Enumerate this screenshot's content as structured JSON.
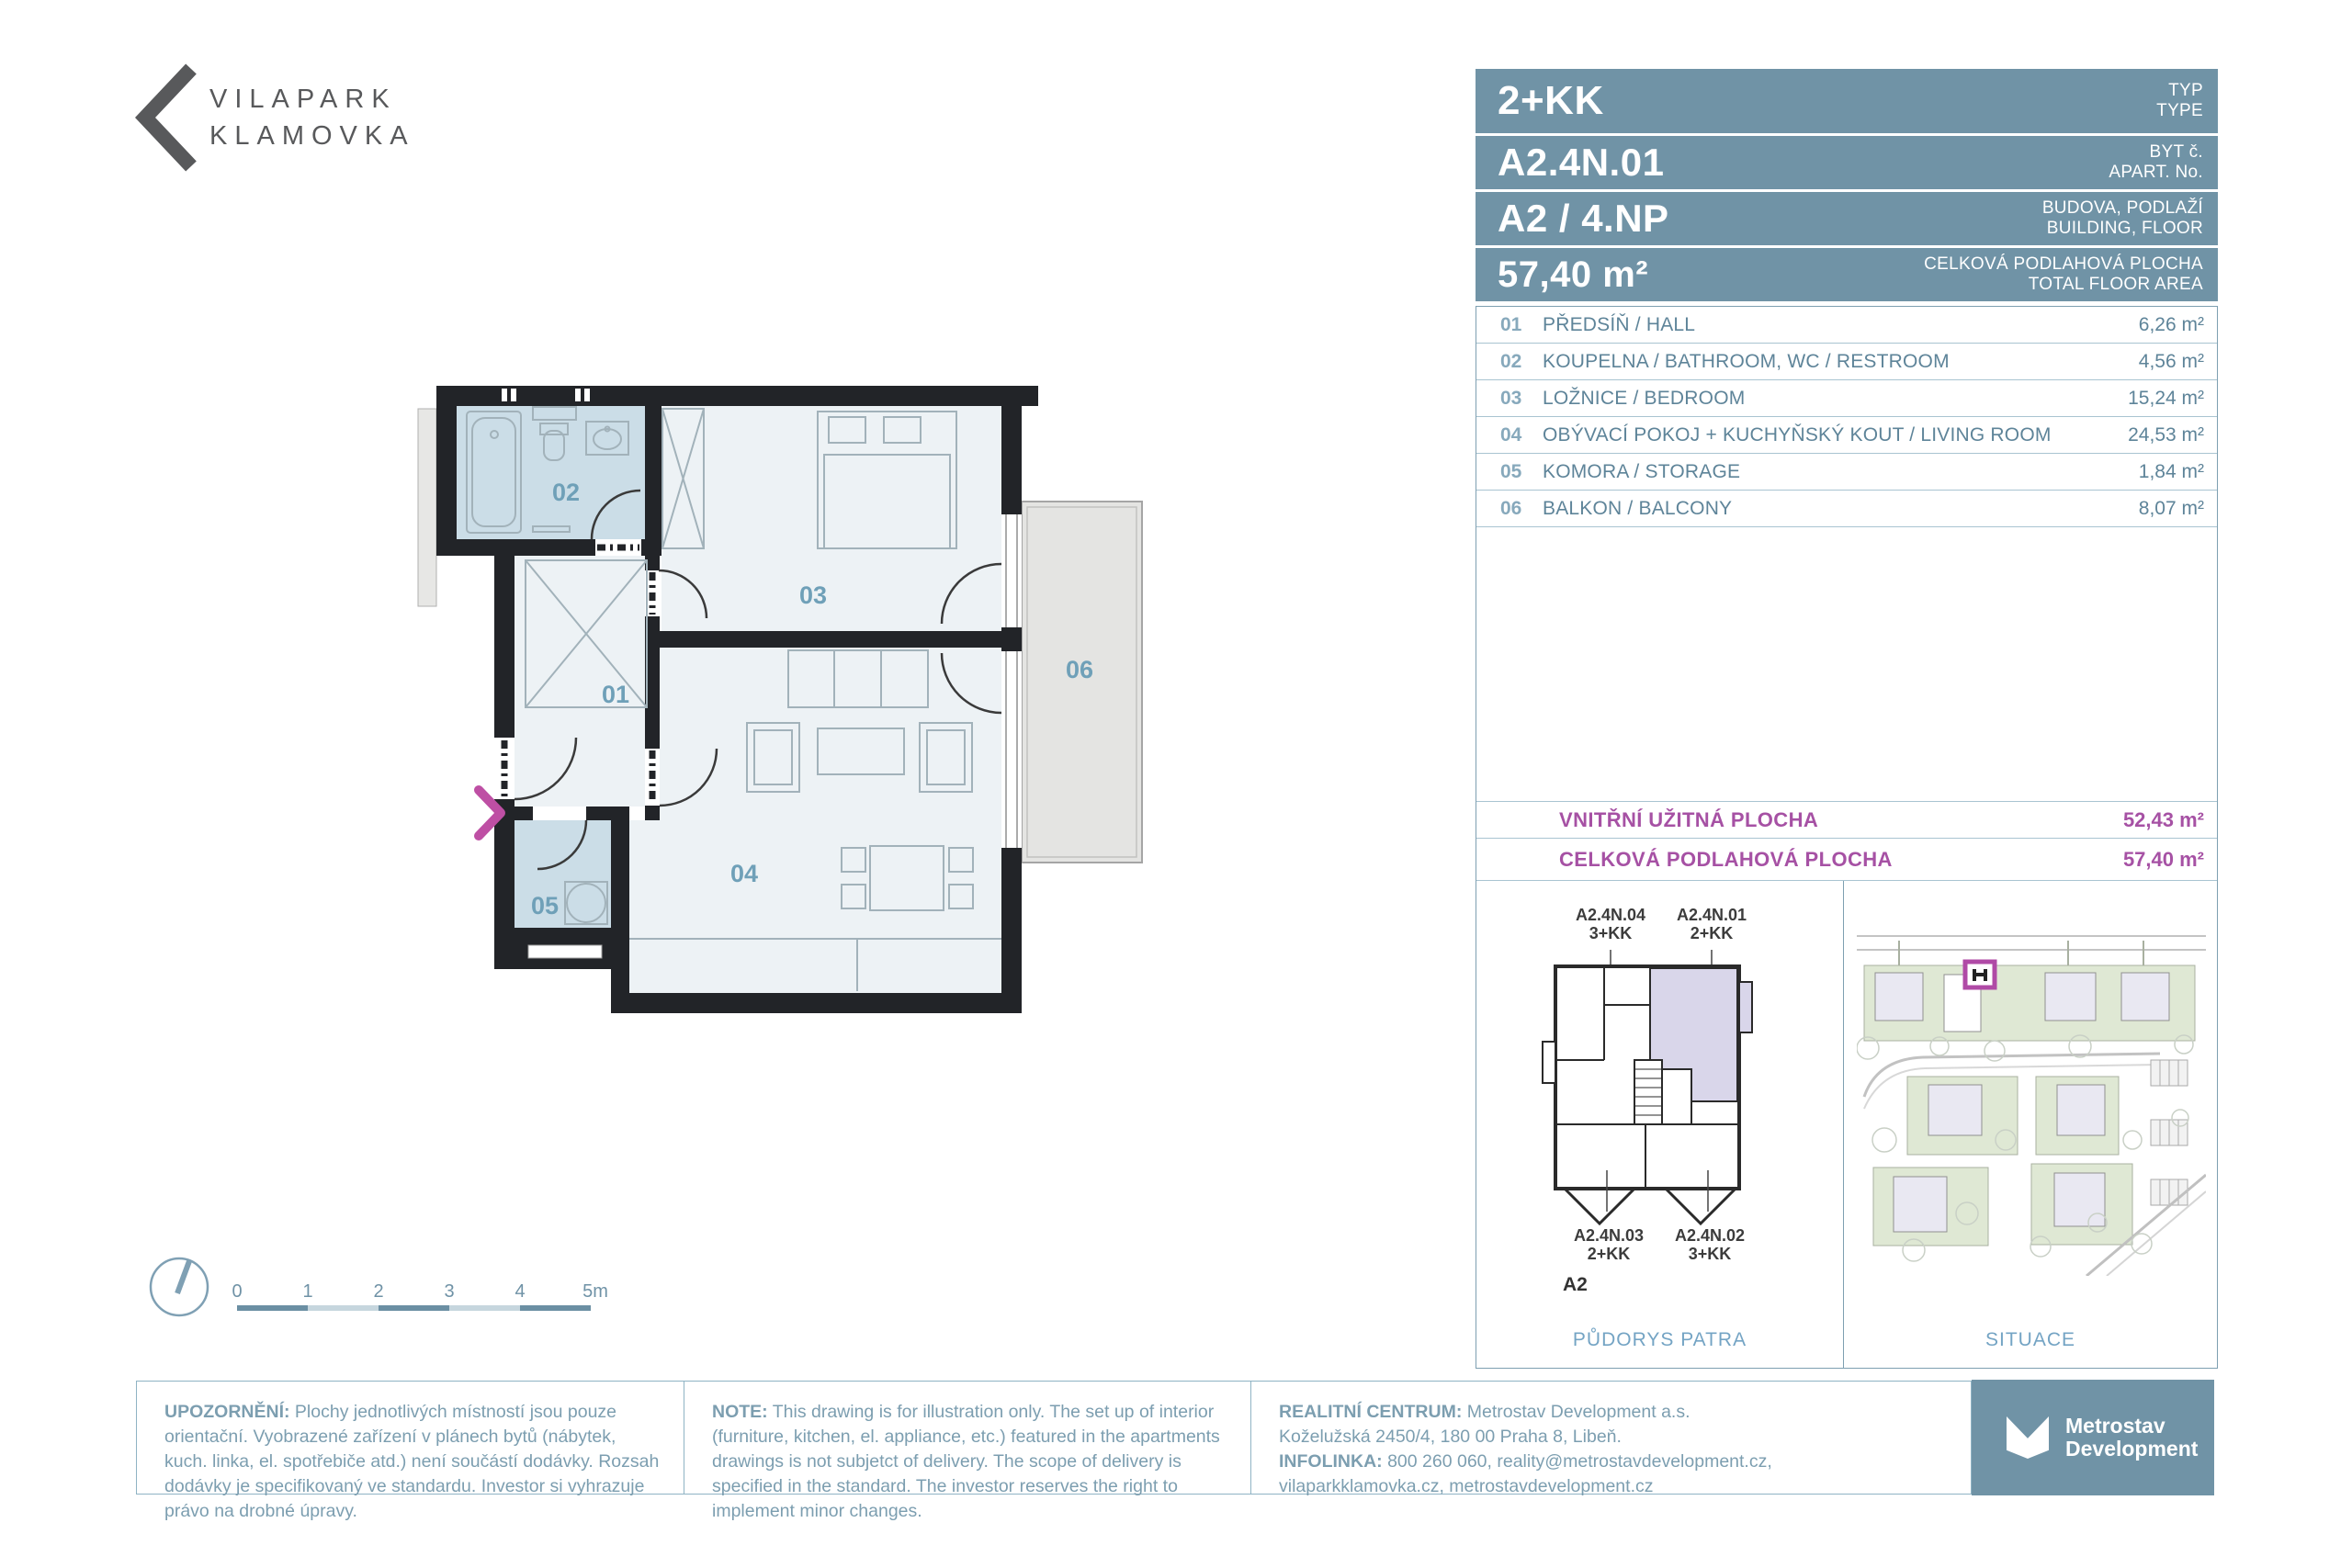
{
  "brand": {
    "line1": "VILAPARK",
    "line2": "KLAMOVKA"
  },
  "header": {
    "type_value": "2+KK",
    "type_label_cs": "TYP",
    "type_label_en": "TYPE",
    "apart_value": "A2.4N.01",
    "apart_label_cs": "BYT č.",
    "apart_label_en": "APART. No.",
    "building_value": "A2 / 4.NP",
    "building_label_cs": "BUDOVA, PODLAŽÍ",
    "building_label_en": "BUILDING, FLOOR",
    "area_value": "57,40 m²",
    "area_label_cs": "CELKOVÁ PODLAHOVÁ PLOCHA",
    "area_label_en": "TOTAL FLOOR AREA"
  },
  "rooms": [
    {
      "no": "01",
      "name": "PŘEDSÍŇ / HALL",
      "area": "6,26 m²"
    },
    {
      "no": "02",
      "name": "KOUPELNA / BATHROOM, WC / RESTROOM",
      "area": "4,56 m²"
    },
    {
      "no": "03",
      "name": "LOŽNICE / BEDROOM",
      "area": "15,24 m²"
    },
    {
      "no": "04",
      "name": "OBÝVACÍ POKOJ + KUCHYŇSKÝ KOUT / LIVING ROOM",
      "area": "24,53 m²"
    },
    {
      "no": "05",
      "name": "KOMORA / STORAGE",
      "area": "1,84 m²"
    },
    {
      "no": "06",
      "name": "BALKON / BALCONY",
      "area": "8,07 m²"
    }
  ],
  "totals": [
    {
      "label": "VNITŘNÍ UŽITNÁ PLOCHA",
      "value": "52,43 m²"
    },
    {
      "label": "CELKOVÁ PODLAHOVÁ PLOCHA",
      "value": "57,40 m²"
    }
  ],
  "floor_units": {
    "top_left": {
      "code": "A2.4N.04",
      "type": "3+KK"
    },
    "top_right": {
      "code": "A2.4N.01",
      "type": "2+KK"
    },
    "bottom_left": {
      "code": "A2.4N.03",
      "type": "2+KK"
    },
    "bottom_right": {
      "code": "A2.4N.02",
      "type": "3+KK"
    },
    "building": "A2"
  },
  "captions": {
    "floor_plan": "PŮDORYS PATRA",
    "situation": "SITUACE"
  },
  "scalebar": {
    "labels": [
      "0",
      "1",
      "2",
      "3",
      "4",
      "5m"
    ]
  },
  "notes": {
    "cs": {
      "label": "UPOZORNĚNÍ:",
      "text": " Plochy jednotlivých místností jsou pouze orientační. Vyobrazené zařízení v plánech bytů (nábytek, kuch. linka, el. spotřebiče atd.) není součástí dodávky. Rozsah dodávky je specifikovaný ve standardu. Investor si vyhrazuje právo na drobné úpravy."
    },
    "en": {
      "label": "NOTE:",
      "text": " This drawing is for illustration only. The set up of interior (furniture, kitchen, el. appliance, etc.) featured in the apartments drawings is not subjetct of delivery. The scope of delivery is specified in the standard. The investor reserves the right to implement minor changes."
    }
  },
  "contact": {
    "label1": "REALITNÍ CENTRUM:",
    "line1": " Metrostav Development a.s.",
    "line2": "Koželužská 2450/4, 180 00 Praha 8, Libeň.",
    "label3": "INFOLINKA:",
    "line3": " 800 260 060, reality@metrostavdevelopment.cz,",
    "line4": "vilaparkklamovka.cz, metrostavdevelopment.cz"
  },
  "developer_logo": {
    "line1": "Metrostav",
    "line2": "Development"
  },
  "colors": {
    "header_blue": "#7093a6",
    "slate_text": "#5e8499",
    "row_number": "#87a9bc",
    "magenta": "#a651a4",
    "entrance_pink": "#be4fa4",
    "caption_blue": "#74a4c4",
    "note_text": "#7c9eb0",
    "wall": "#222428",
    "room_fill": "#edf2f5",
    "wet_room_fill": "#cbdde7",
    "balcony_fill": "#e4e4e2",
    "furniture": "#a2b2ba",
    "highlight_lavender": "#d9d6ea",
    "site_green": "#dfe8d4",
    "logo_gray": "#58595b"
  }
}
